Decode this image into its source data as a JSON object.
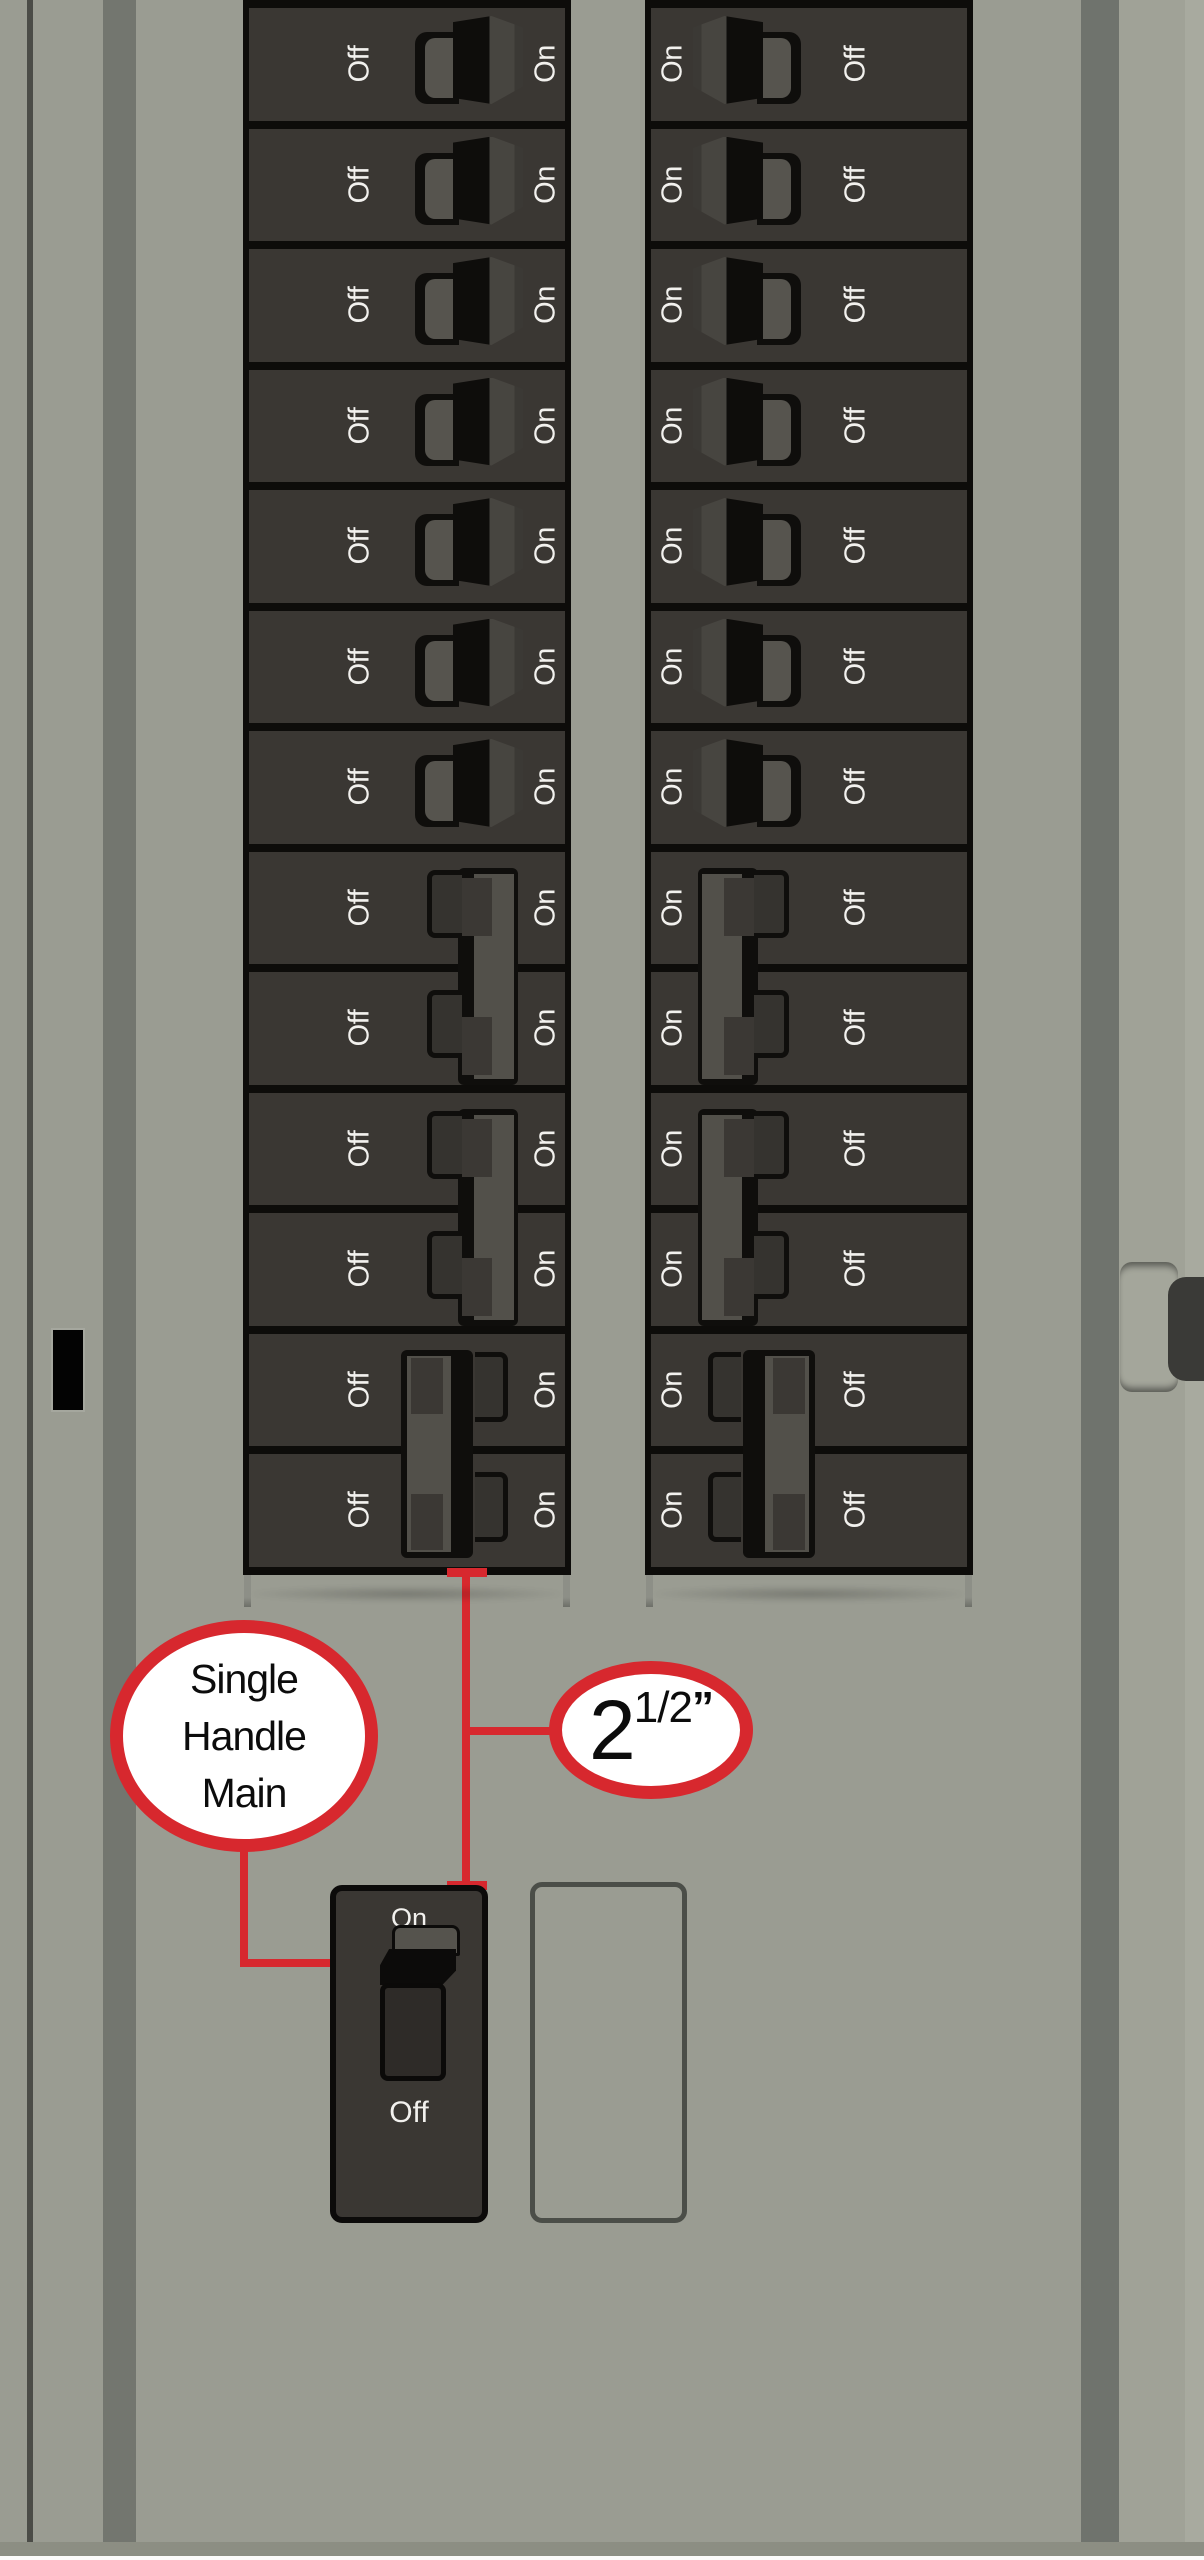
{
  "panel": {
    "background_color": "#9a9c92",
    "breaker_color": "#3a3733",
    "accent_red": "#d7282e",
    "columns": [
      {
        "side": "left",
        "label_left": "Off",
        "label_right": "On",
        "rows": [
          "single",
          "single",
          "single",
          "single",
          "single",
          "single",
          "single",
          "pairA_top",
          "pairA_bottom",
          "pairA_top",
          "pairA_bottom",
          "pairB_top",
          "pairB_bottom"
        ]
      },
      {
        "side": "right",
        "label_left": "On",
        "label_right": "Off",
        "rows": [
          "single",
          "single",
          "single",
          "single",
          "single",
          "single",
          "single",
          "pairA_top",
          "pairA_bottom",
          "pairA_top",
          "pairA_bottom",
          "pairB_top",
          "pairB_bottom"
        ]
      }
    ]
  },
  "callouts": {
    "single_handle_main": {
      "line1": "Single",
      "line2": "Handle",
      "line3": "Main"
    },
    "measurement": {
      "value": "2",
      "fraction": "1/2",
      "unit": "”"
    }
  },
  "main_breaker": {
    "on_label": "On",
    "off_label": "Off"
  }
}
